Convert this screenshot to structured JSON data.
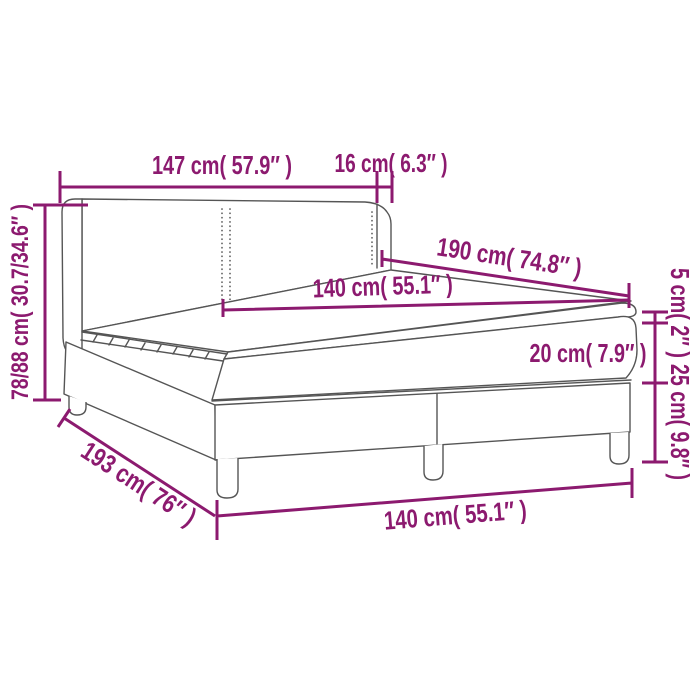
{
  "diagram": {
    "title": "box-spring-bed-dimension-diagram",
    "colors": {
      "accent": "#8c1a6f",
      "line_art": "#555555",
      "background": "#ffffff"
    },
    "labels": {
      "headboard_width": "147 cm( 57.9″ )",
      "wing_depth": "16 cm( 6.3″ )",
      "total_height": "78/88 cm( 30.7/34.6″ )",
      "bed_length": "190 cm( 74.8″ )",
      "mattress_width_top": "140 cm( 55.1″ )",
      "topper_height": "5 cm( 2″ )",
      "mattress_height": "20 cm( 7.9″ )",
      "base_height": "25 cm( 9.8″ )",
      "base_length": "193 cm( 76″ )",
      "base_width_bottom": "140 cm( 55.1″ )"
    }
  }
}
